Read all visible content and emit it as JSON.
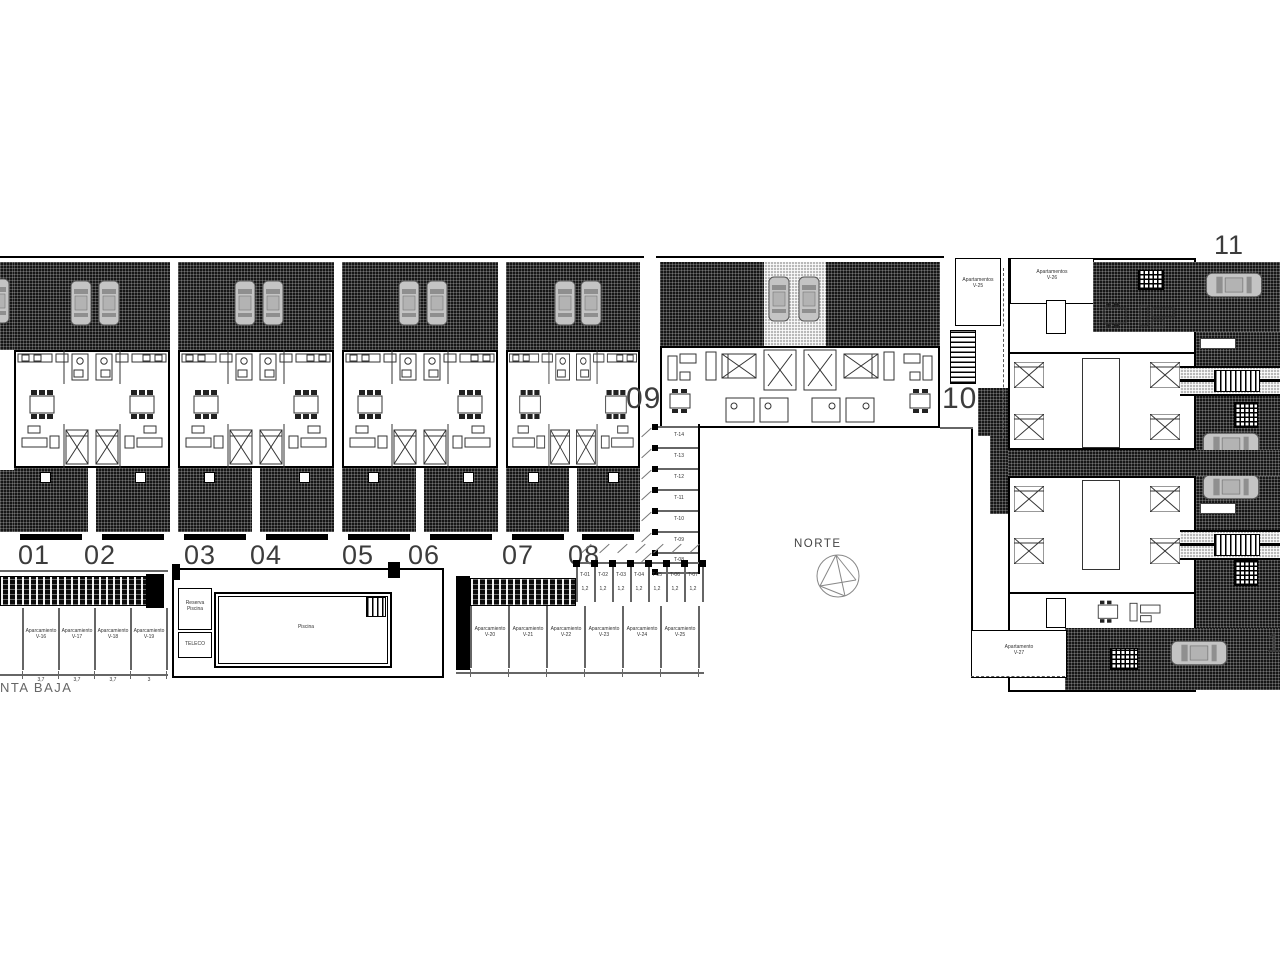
{
  "plan": {
    "title_partial": "NTA BAJA",
    "north_label": "NORTE"
  },
  "row_units": {
    "numbers": [
      "01",
      "02",
      "03",
      "04",
      "05",
      "06",
      "07",
      "08"
    ]
  },
  "mid_block": {
    "left_number": "09",
    "right_number": "10"
  },
  "right_block": {
    "top_number": "11",
    "bottom_number_partial": "1"
  },
  "apartment_boxes": {
    "v25": {
      "line1": "Apartamentos",
      "line2": "V-25"
    },
    "v26": {
      "line1": "Apartamentos",
      "line2": "V-26"
    },
    "v27": {
      "line1": "Apartamento",
      "line2": "V-27"
    }
  },
  "pool": {
    "label": "Piscina",
    "plant_room_line1": "Reserva",
    "plant_room_line2": "Piscina",
    "utility_room": "TELECO"
  },
  "parking_left": {
    "bays": [
      {
        "line1": "Aparcamiento",
        "code": "V-16",
        "dim": "3,7"
      },
      {
        "line1": "Aparcamiento",
        "code": "V-17",
        "dim": "3,7"
      },
      {
        "line1": "Aparcamiento",
        "code": "V-18",
        "dim": "3,7"
      },
      {
        "line1": "Aparcamiento",
        "code": "V-19",
        "dim": "3"
      }
    ]
  },
  "parking_mid": {
    "bays": [
      {
        "line1": "Aparcamiento",
        "code": "V-20"
      },
      {
        "line1": "Aparcamiento",
        "code": "V-21"
      },
      {
        "line1": "Aparcamiento",
        "code": "V-22"
      },
      {
        "line1": "Aparcamiento",
        "code": "V-23"
      },
      {
        "line1": "Aparcamiento",
        "code": "V-24"
      },
      {
        "line1": "Aparcamiento",
        "code": "V-25"
      }
    ]
  },
  "moto_stalls": {
    "labels": [
      "T-01",
      "T-02",
      "T-03",
      "T-04",
      "T-05",
      "T-06",
      "T-07"
    ],
    "width_label": "1,2"
  },
  "storage_stalls": {
    "labels": [
      "T-14",
      "T-13",
      "T-12",
      "T-11",
      "T-10",
      "T-09",
      "T-08"
    ]
  }
}
